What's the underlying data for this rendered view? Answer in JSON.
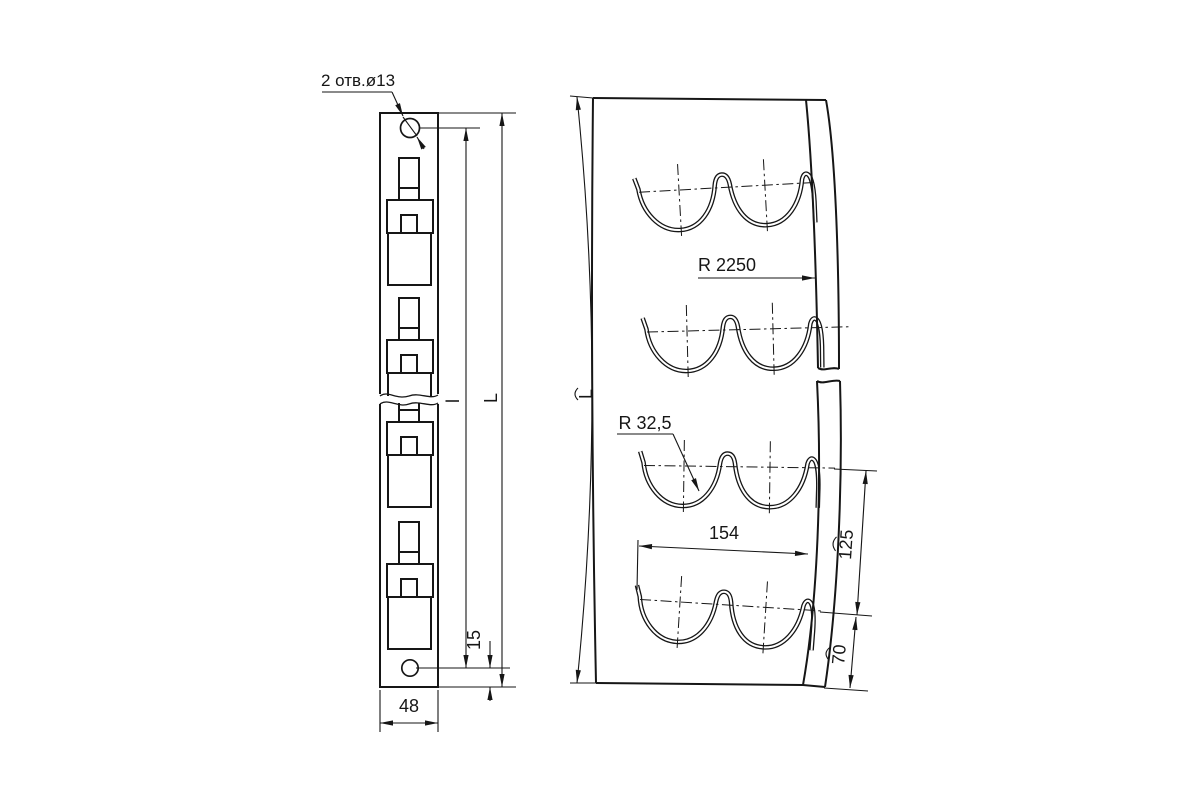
{
  "drawing": {
    "colors": {
      "background": "#ffffff",
      "ink": "#161616"
    },
    "annotations": {
      "holes_note": "2 отв.ø13",
      "strip_width": "48",
      "hole_edge_offset": "15",
      "hole_spacing": "l",
      "overall_length": "L",
      "bend_radius": "R 2250",
      "cutout_radius": "R 32,5",
      "cutout_width": "154",
      "cutout_pitch": "125",
      "cutout_end_offset": "70",
      "developed_length": "L"
    }
  }
}
